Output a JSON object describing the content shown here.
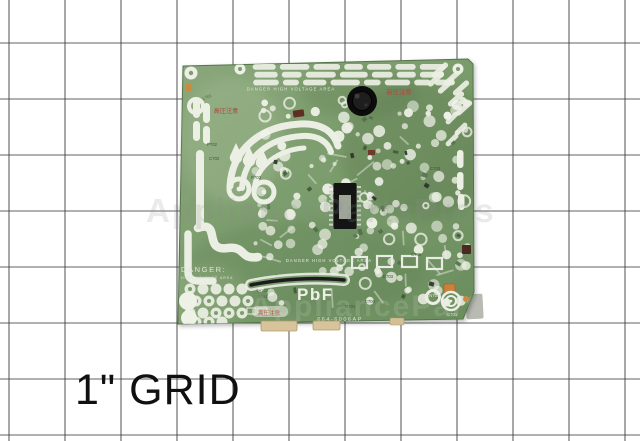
{
  "image": {
    "grid_caption": "1\" GRID",
    "watermark": "AppliancePartsPros"
  },
  "board": {
    "silkscreen": {
      "danger_top": "DANGER HIGH VOLTAGE AREA",
      "danger_center": "DANGER HIGH VOLTAGE AREA",
      "danger_left_title": "DANGER:",
      "danger_left_sub": "HIGH VOLTAGE AREA",
      "pbf_marking": "PbF",
      "part_number": "664-6006AP",
      "jp_warning_top": "高圧注意",
      "jp_warning_left": "高圧注意",
      "jp_warning_bottom": "高圧注意"
    },
    "component_labels": [
      "L701",
      "P702",
      "C702",
      "P703",
      "TH702",
      "D701",
      "R701",
      "E700",
      "E703",
      "CN703",
      "C701",
      "C703",
      "C705"
    ],
    "colors": {
      "board_green": "#7d9c70",
      "board_green_dark": "#5e8052",
      "silkscreen_white": "#ecefe4",
      "warning_red": "#b0493d",
      "connector_tan": "#d8c49b",
      "component_black": "#141414",
      "grid_line": "#454545"
    }
  }
}
